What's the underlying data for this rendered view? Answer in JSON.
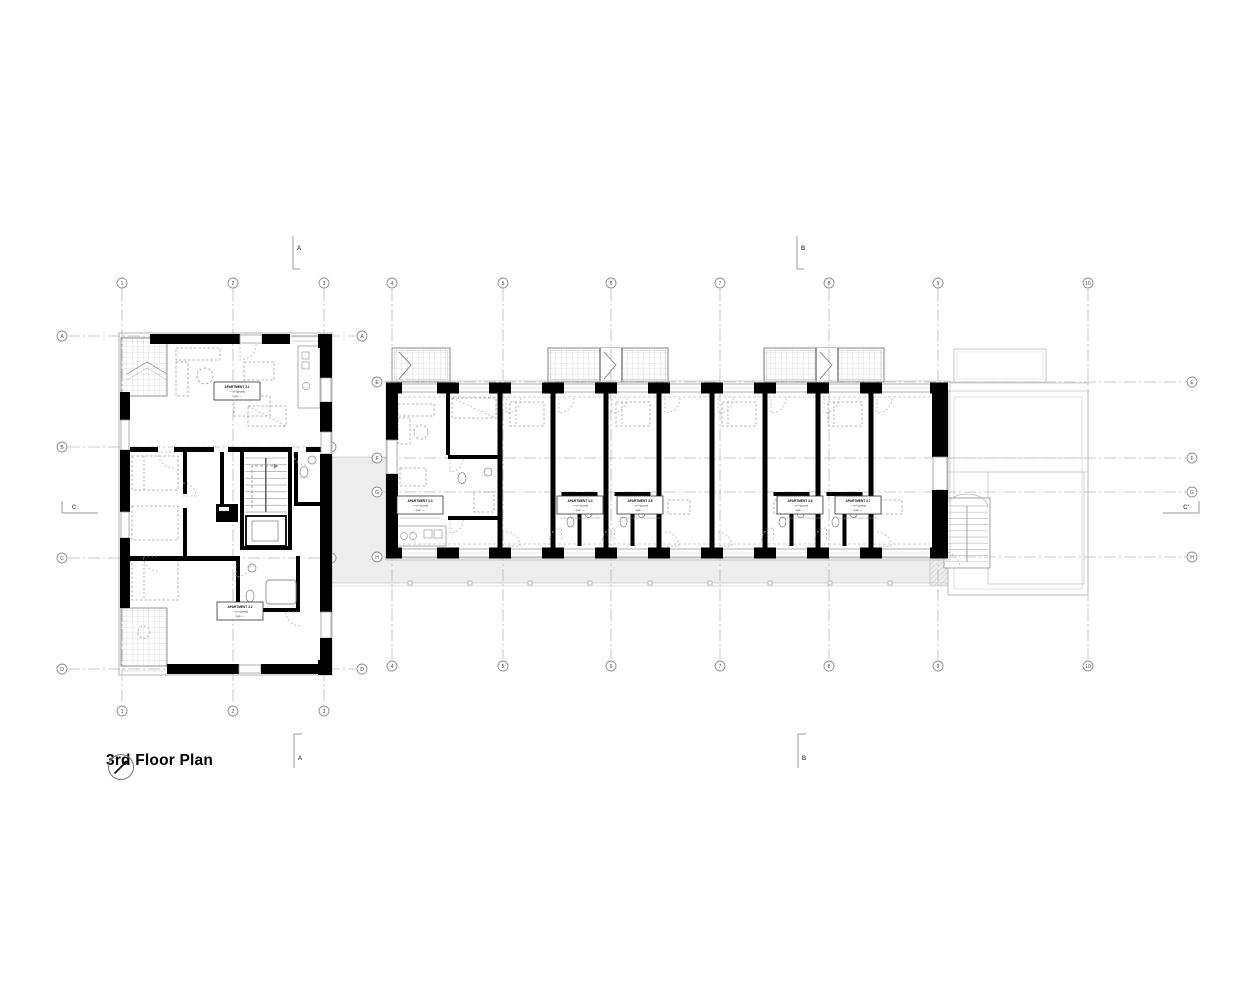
{
  "title": {
    "label": "3rd Floor Plan"
  },
  "grid": {
    "columns": [
      "1",
      "2",
      "3",
      "4",
      "5",
      "6",
      "7",
      "8",
      "9",
      "10"
    ],
    "block_rows": [
      "A",
      "B",
      "C",
      "D"
    ],
    "bar_rows": [
      "E",
      "F",
      "G",
      "H"
    ]
  },
  "sections": {
    "top_left": "A",
    "top_right": "B",
    "bottom_left": "A",
    "bottom_right": "B",
    "left": "C",
    "right": "C'"
  },
  "apartments": [
    {
      "title": "APARTMENT 3.1",
      "area": "— m² (gross)",
      "type": "type —"
    },
    {
      "title": "APARTMENT 3.2",
      "area": "— m² (gross)",
      "type": "type —"
    },
    {
      "title": "APARTMENT 3.3",
      "area": "— m² (gross)",
      "type": "type —"
    },
    {
      "title": "APARTMENT 3.4",
      "area": "— m² (gross)",
      "type": "type —"
    },
    {
      "title": "APARTMENT 3.5",
      "area": "— m² (gross)",
      "type": "type —"
    },
    {
      "title": "APARTMENT 3.6",
      "area": "— m² (gross)",
      "type": "type —"
    },
    {
      "title": "APARTMENT 3.7",
      "area": "— m² (gross)",
      "type": "type —"
    }
  ],
  "colors": {
    "wall": "#000000",
    "thin_line": "#9a9a9a",
    "light_line": "#c6c6c6",
    "grid_line": "#b8b8b8",
    "walkway_fill": "#ededed",
    "text": "#1a1a1a"
  }
}
